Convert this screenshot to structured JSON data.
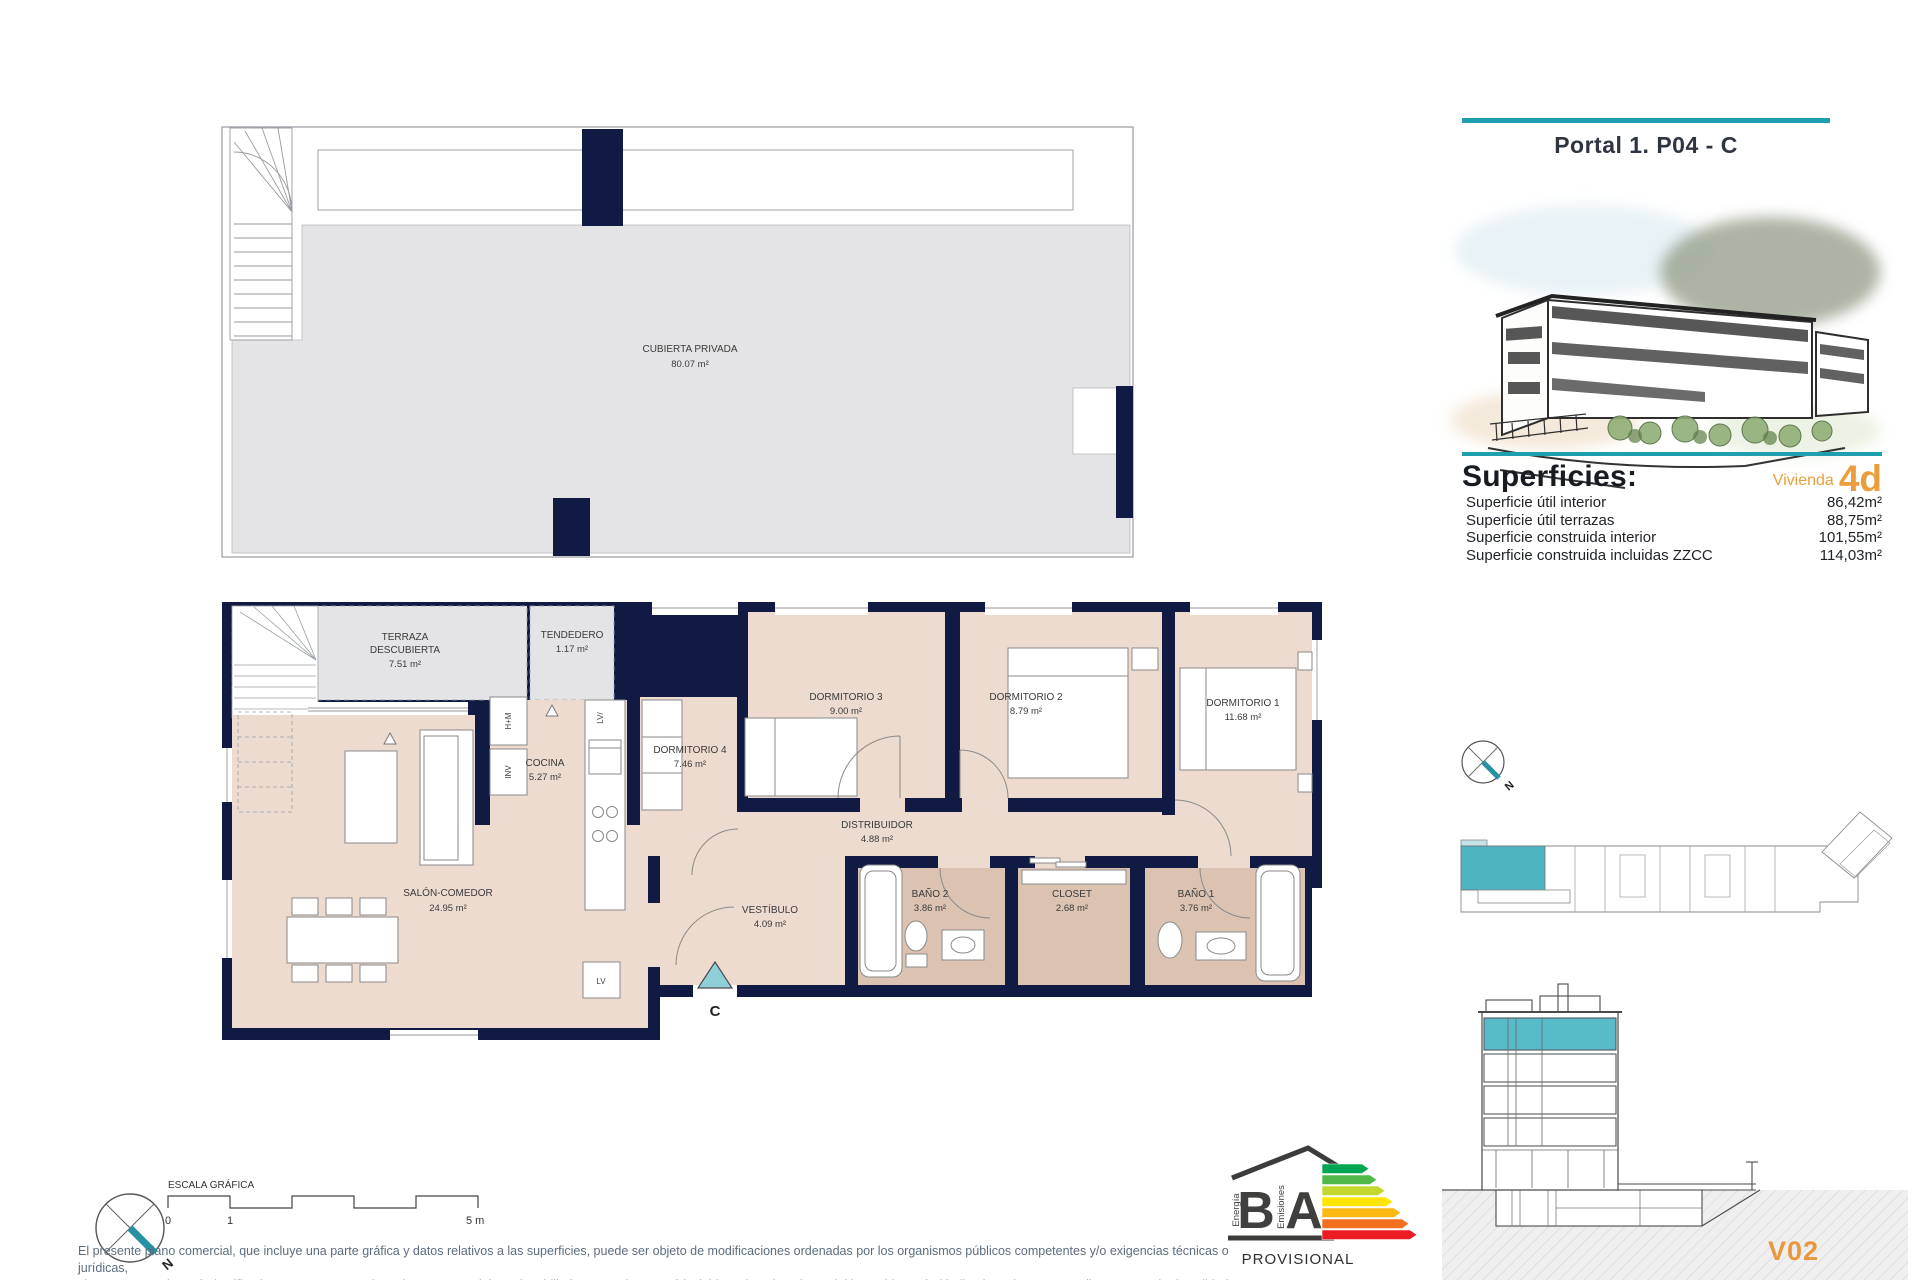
{
  "header": {
    "title": "Portal 1. P04 - C"
  },
  "superficies": {
    "heading": "Superficies:",
    "vivienda_label": "Vivienda",
    "vivienda_code": "4d",
    "rows": [
      {
        "label": "Superficie útil interior",
        "value": "86,42m²"
      },
      {
        "label": "Superficie útil terrazas",
        "value": "88,75m²"
      },
      {
        "label": "Superficie construida interior",
        "value": "101,55m²"
      },
      {
        "label": "Superficie construida incluidas ZZCC",
        "value": "114,03m²"
      }
    ]
  },
  "roof_plan": {
    "name": "CUBIERTA PRIVADA",
    "area": "80.07 m²"
  },
  "rooms": {
    "terraza": {
      "l1": "TERRAZA",
      "l2": "DESCUBIERTA",
      "area": "7.51 m²"
    },
    "tendedero": {
      "name": "TENDEDERO",
      "area": "1.17 m²"
    },
    "cocina": {
      "name": "COCINA",
      "area": "5.27 m²"
    },
    "dormitorio4": {
      "name": "DORMITORIO 4",
      "area": "7.46 m²"
    },
    "dormitorio3": {
      "name": "DORMITORIO 3",
      "area": "9.00 m²"
    },
    "dormitorio2": {
      "name": "DORMITORIO 2",
      "area": "8.79 m²"
    },
    "dormitorio1": {
      "name": "DORMITORIO 1",
      "area": "11.68 m²"
    },
    "salon": {
      "name": "SALÓN-COMEDOR",
      "area": "24.95 m²"
    },
    "distribuidor": {
      "name": "DISTRIBUIDOR",
      "area": "4.88 m²"
    },
    "vestibulo": {
      "name": "VESTÍBULO",
      "area": "4.09 m²"
    },
    "bano2": {
      "name": "BAÑO 2",
      "area": "3.86 m²"
    },
    "closet": {
      "name": "CLOSET",
      "area": "2.68 m²"
    },
    "bano1": {
      "name": "BAÑO 1",
      "area": "3.76 m²"
    }
  },
  "plan_marks": {
    "entry": "C",
    "hm": "H+M",
    "inv": "INV",
    "lv_top": "LV/",
    "lv": "LV"
  },
  "scale": {
    "title": "ESCALA GRÁFICA",
    "t0": "0",
    "t1": "1",
    "t5": "5 m"
  },
  "compass": {
    "north": "N"
  },
  "energy": {
    "b": "B",
    "a": "A",
    "energia": "Energía",
    "emisiones": "Emisiones",
    "provisional": "PROVISIONAL",
    "colors": [
      "#00a651",
      "#50b848",
      "#c3d82e",
      "#ffe500",
      "#fdb913",
      "#f37021",
      "#ed1c24"
    ]
  },
  "plan_code": "V02",
  "disclaimer": {
    "line1": "El presente plano comercial, que incluye una parte gráfica y datos relativos a las superficies, puede ser objeto de modificaciones ordenadas por los organismos públicos competentes y/o exigencias técnicas o jurídicas,",
    "line2": "siempre y cuando estén justificados y no supongan alteraciones sustanciales. El mobiliario mostrado no está incluido y el equipamiento del inmueble será el indicado en la correspondiente memoria de calidades"
  },
  "colors": {
    "accent_teal": "#1d9fb0",
    "accent_orange": "#ea9f3c",
    "wall_navy": "#111a42",
    "floor_beige": "#eddbd0",
    "floor_tan": "#dcc3b1",
    "roof_gray": "#e4e4e6"
  }
}
